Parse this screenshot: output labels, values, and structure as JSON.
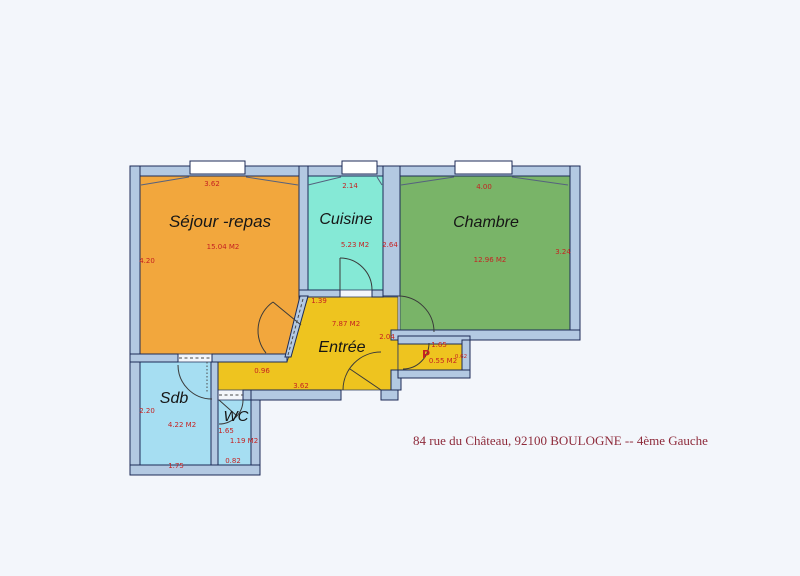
{
  "plan": {
    "address": "84 rue du Château, 92100 BOULOGNE -- 4ème Gauche",
    "rooms": {
      "sejour": {
        "label": "Séjour -repas",
        "area": "15.04 M2",
        "dim_top": "3.62",
        "dim_left": "4.20"
      },
      "cuisine": {
        "label": "Cuisine",
        "area": "5.23 M2",
        "dim_top": "2.14",
        "dim_right": "2.64"
      },
      "chambre": {
        "label": "Chambre",
        "area": "12.96 M2",
        "dim_top": "4.00",
        "dim_right": "3.24"
      },
      "entree": {
        "label": "Entrée",
        "area": "7.87 M2",
        "dim_top_left": "1.39",
        "dim_right": "2.04",
        "dim_corridor": "0.96",
        "dim_bottom": "3.62"
      },
      "placard": {
        "label": "P",
        "area": "0.55 M2",
        "dim_top": "1.65",
        "dim_right": "0.62"
      },
      "sdb": {
        "label": "Sdb",
        "area": "4.22 M2",
        "dim_left": "2.20",
        "dim_bottom": "1.75"
      },
      "wc": {
        "label": "WC",
        "area": "1.19 M2",
        "dim_left": "1.65",
        "dim_bottom": "0.82"
      }
    },
    "colors": {
      "background": "#f3f6fb",
      "wall_fill": "#b3c9e2",
      "wall_line": "#1c2b57",
      "sejour": "#f2a73d",
      "cuisine": "#85e9d6",
      "chambre": "#79b468",
      "entree": "#eec41f",
      "water": "#a6def2",
      "dim_text": "#c52222",
      "address_text": "#8e2b3b"
    }
  }
}
